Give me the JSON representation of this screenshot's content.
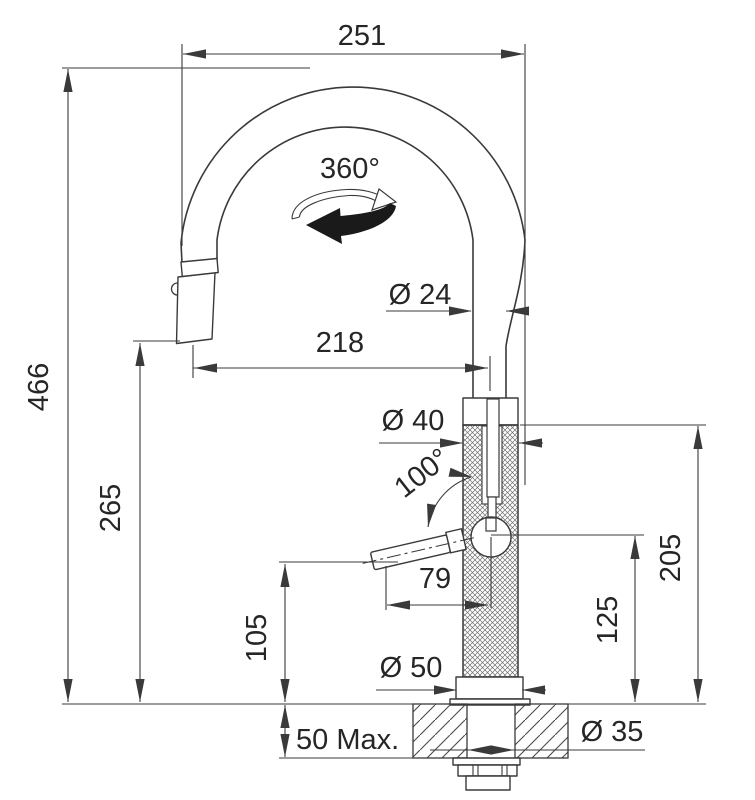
{
  "drawing": {
    "type": "Kitchen pull-down faucet installation dimension drawing",
    "units": "mm",
    "colors": {
      "line": "#3a3a3a",
      "text": "#262626",
      "background": "#ffffff"
    },
    "dimensions": {
      "top_width": "251",
      "total_height": "466",
      "spray_outlet_height": "265",
      "spout_reach": "218",
      "spout_tube_diameter": "Ø 24",
      "swivel_angle": "360°",
      "body_diameter": "Ø 40",
      "lever_angle": "100°",
      "lever_length": "79",
      "lever_clearance_height": "105",
      "base_diameter": "Ø 50",
      "body_height": "205",
      "lever_pivot_height": "125",
      "deck_thickness_max": "50 Max.",
      "hole_diameter": "Ø 35"
    }
  }
}
